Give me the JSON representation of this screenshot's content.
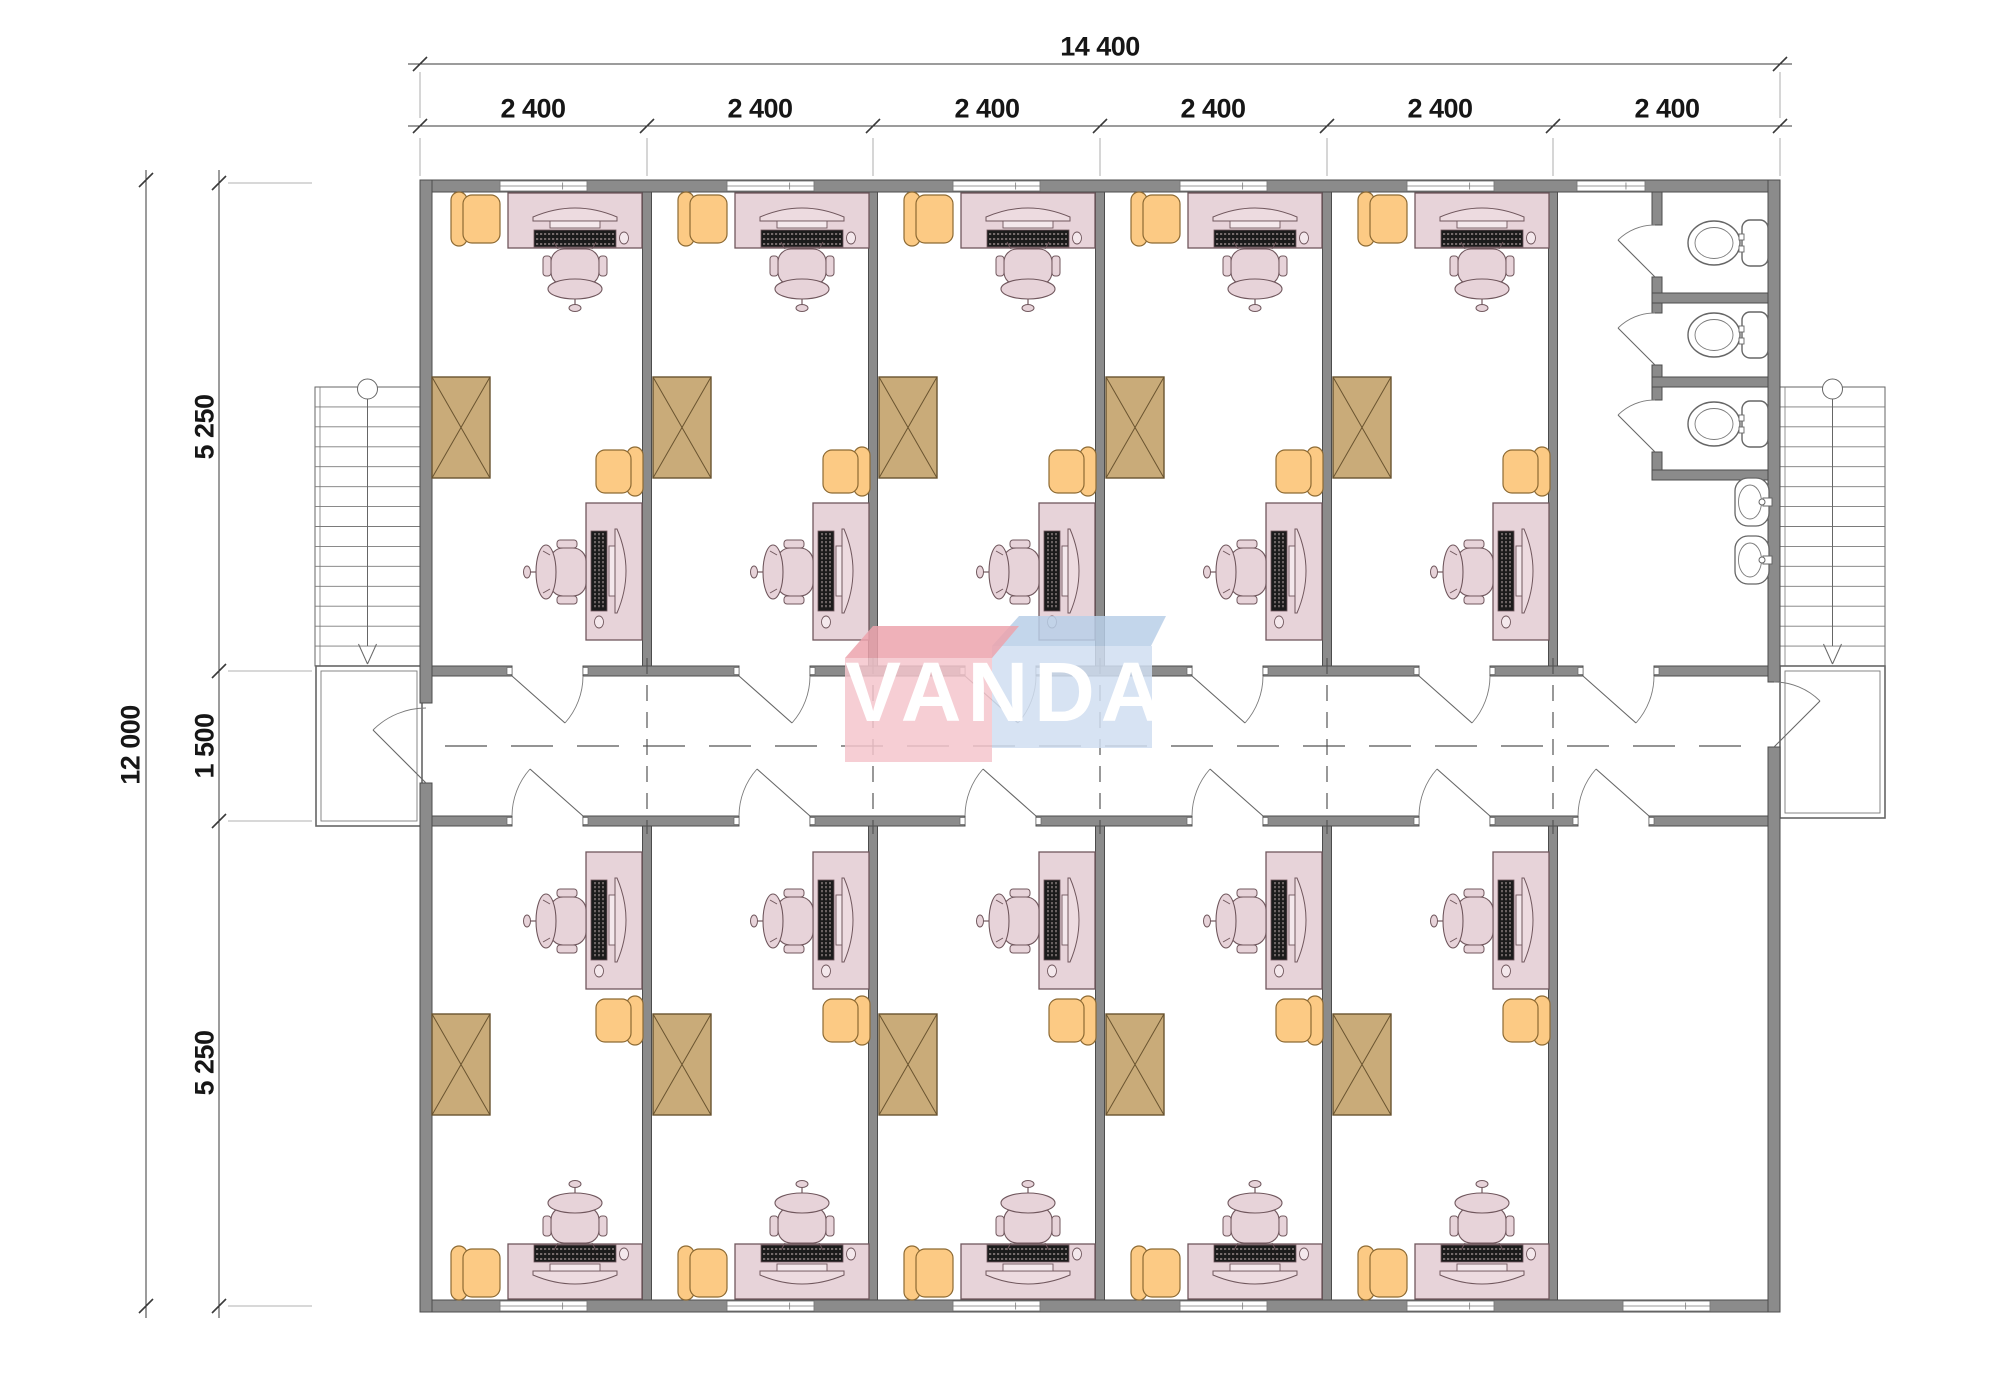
{
  "drawing": {
    "watermark_text": "VANDA",
    "dimensions": {
      "horizontal_total": "14 400",
      "horizontal_segments": [
        "2 400",
        "2 400",
        "2 400",
        "2 400",
        "2 400",
        "2 400"
      ],
      "vertical_total": "12 000",
      "vertical_segments": [
        "5 250",
        "1 500",
        "5 250"
      ]
    },
    "rooms": {
      "offices_top_row": 5,
      "offices_bottom_row": 5,
      "empty_room_bottom_right": 1,
      "wc_stalls": 3,
      "toilets": 3,
      "wash_basins": 2,
      "staircases": 2,
      "entrance_landings": 2
    },
    "furniture_per_office": {
      "desks": 2,
      "task_chairs": 2,
      "armchairs": 2,
      "cabinets": 1,
      "computers": 2
    },
    "colors": {
      "wall": "#8b8b8b",
      "wall_edge": "#4c4c4c",
      "line": "#666666",
      "thin_line": "#7a7a7a",
      "dash": "#555555",
      "desk_fill": "#e7d3d9",
      "desk_edge": "#70575d",
      "pc_dark": "#1b1b1b",
      "armchair_fill": "#fcca84",
      "armchair_edge": "#8d6a33",
      "cabinet_fill": "#c9ab79",
      "cabinet_edge": "#6a5430",
      "dim_line": "#3a3a3a",
      "dim_text": "#161616",
      "logo_pink_face": "#f5c6cd",
      "logo_pink_top": "#eca3ad",
      "logo_blue_face": "#d0def1",
      "logo_blue_top": "#b9cfe8"
    }
  }
}
